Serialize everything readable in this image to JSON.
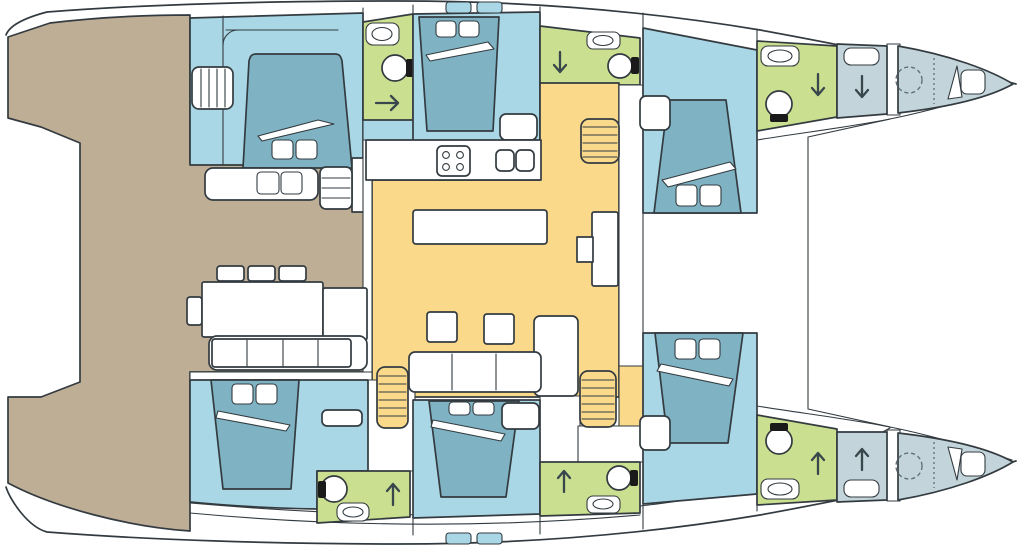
{
  "title": "Catamaran interior layout deck plan",
  "colors": {
    "deck": "#bfae96",
    "cabin": "#a9d7e5",
    "bed": "#7fb3c3",
    "bathroom": "#cadf8f",
    "saloon": "#fad98b",
    "forepeak": "#c3d5da",
    "outline": "#333b40",
    "white": "#ffffff",
    "black": "#1a1a1a"
  },
  "areas": {
    "cockpit": "aft cockpit deck with dining table and benches",
    "saloon": "central saloon with galley, island table and seating",
    "cabins": "four double guest cabins with beds and pillows",
    "bathrooms": "four bathrooms with toilet, sink and shower",
    "forepeaks": "two bow compartments with single berths",
    "stairs": "three companionway staircases from saloon to hulls"
  },
  "counts": {
    "double_beds": 6,
    "single_berths": 2,
    "toilets": 6,
    "staircases": 3
  }
}
